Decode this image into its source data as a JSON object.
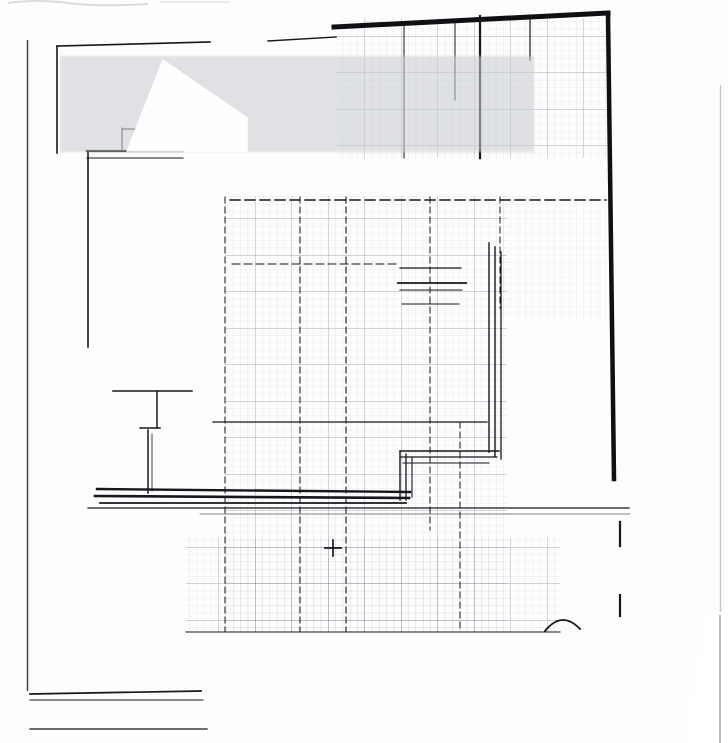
{
  "plan": {
    "floor_label": "ANO SESTO",
    "stairs_label": "SCAL",
    "spare_label": "SP.",
    "ink_color": "#16161d"
  },
  "watermark": {
    "brand": "GiULiA",
    "tagline": {
      "left": "ASTE GIUDIZIARIE",
      "bullet": "•",
      "right": "REAL ESTATE"
    },
    "band_color": "#c9cdd3",
    "text_color": "#ffffff"
  }
}
